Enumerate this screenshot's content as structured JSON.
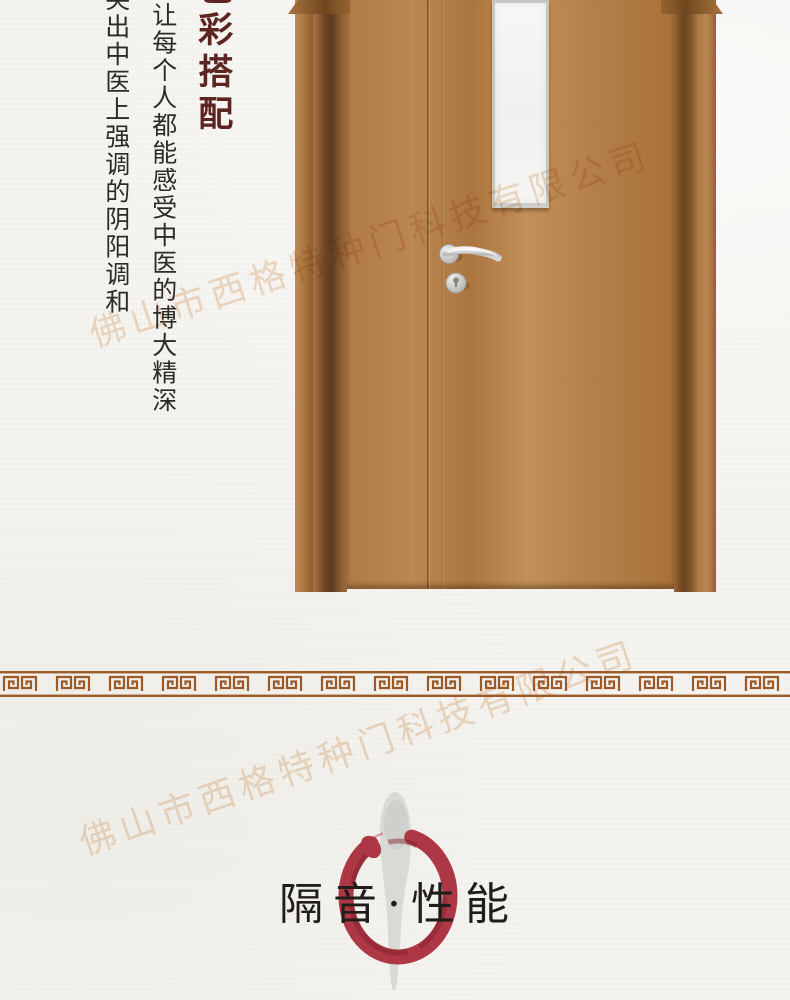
{
  "meta": {
    "watermark_text": "佛山市西格特种门科技有限公司",
    "watermark_color": "#e0a873",
    "page_bg": "#f5f4f0"
  },
  "intro": {
    "vertical_title": "色彩搭配",
    "vertical_title_color": "#5d2420",
    "line1": "让每个人都能感受中医的博大精深",
    "line2": "突出中医上强调的阴阳调和",
    "text_color": "#2e2b27"
  },
  "door": {
    "kind": "wood-door-with-vision-glass-panel",
    "wood_hex": "#b5804a",
    "wood_dark_hex": "#5f3b1e",
    "glass_hex": "#f3f3f1",
    "hardware_hex": "#c8c8c5"
  },
  "divider": {
    "style": "greek-key-meander-border",
    "color_hex": "#9c5a28"
  },
  "section": {
    "title": "隔音·性能",
    "title_color": "#201d1a",
    "enso_circle_hex": "#ad3744",
    "brush_stroke_hex": "#d9d9d6"
  }
}
